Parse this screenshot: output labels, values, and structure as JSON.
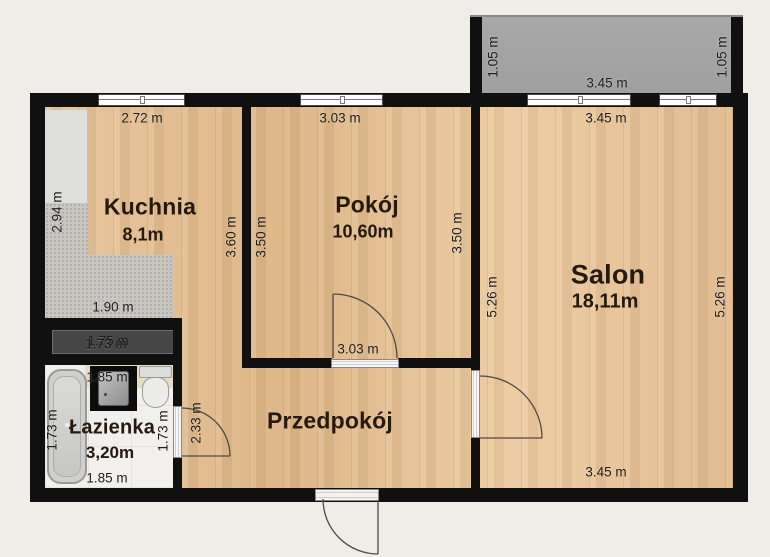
{
  "meta": {
    "type": "apartment-floor-plan",
    "language": "pl"
  },
  "colors": {
    "background": "#f0ede8",
    "wall": "#101010",
    "wood_floor": "#e5bf93",
    "balcony": "#a2a2a2",
    "kitchen_counter": "#cac7c2",
    "closet": "#464646",
    "bathroom_floor": "#f2f0ec",
    "label_text": "#1e1e1e"
  },
  "rooms": [
    {
      "id": "kuchnia",
      "name": "Kuchnia",
      "area": "8,1m",
      "x": 150,
      "y": 207,
      "area_x": 143,
      "area_y": 235,
      "cls": "room-md"
    },
    {
      "id": "pokoj",
      "name": "Pokój",
      "area": "10,60m",
      "x": 367,
      "y": 205,
      "area_x": 363,
      "area_y": 232,
      "cls": "room-md"
    },
    {
      "id": "salon",
      "name": "Salon",
      "area": "18,11m",
      "x": 608,
      "y": 275,
      "area_x": 605,
      "area_y": 302,
      "cls": "room-lg"
    },
    {
      "id": "przedpokoj",
      "name": "Przedpokój",
      "area": "",
      "x": 330,
      "y": 421,
      "cls": "room-md"
    },
    {
      "id": "lazienka",
      "name": "Łazienka",
      "area": "3,20m",
      "x": 112,
      "y": 428,
      "area_x": 110,
      "area_y": 453,
      "cls": "room-sm"
    }
  ],
  "dimension_labels": [
    {
      "text": "2.72 m",
      "x": 142,
      "y": 118,
      "rot": false
    },
    {
      "text": "3.03 m",
      "x": 340,
      "y": 118,
      "rot": false
    },
    {
      "text": "3.45 m",
      "x": 607,
      "y": 83,
      "rot": false
    },
    {
      "text": "3.45 m",
      "x": 606,
      "y": 118,
      "rot": false
    },
    {
      "text": "1.05 m",
      "x": 493,
      "y": 57,
      "rot": true
    },
    {
      "text": "1.05 m",
      "x": 722,
      "y": 57,
      "rot": true
    },
    {
      "text": "2.94 m",
      "x": 57,
      "y": 212,
      "rot": true
    },
    {
      "text": "3.60 m",
      "x": 231,
      "y": 237,
      "rot": true
    },
    {
      "text": "3.50 m",
      "x": 261,
      "y": 237,
      "rot": true
    },
    {
      "text": "3.50 m",
      "x": 457,
      "y": 233,
      "rot": true
    },
    {
      "text": "5.26 m",
      "x": 492,
      "y": 297,
      "rot": true
    },
    {
      "text": "5.26 m",
      "x": 720,
      "y": 297,
      "rot": true
    },
    {
      "text": "1.90 m",
      "x": 113,
      "y": 307,
      "rot": false
    },
    {
      "text": "1.75 m",
      "x": 108,
      "y": 341,
      "rot": false,
      "dark": true
    },
    {
      "text": "1.73 m",
      "x": 106,
      "y": 344,
      "rot": false,
      "dark": true
    },
    {
      "text": "1.85 m",
      "x": 107,
      "y": 377,
      "rot": false
    },
    {
      "text": "1.73 m",
      "x": 52,
      "y": 430,
      "rot": true
    },
    {
      "text": "1.73 m",
      "x": 163,
      "y": 431,
      "rot": true
    },
    {
      "text": "1.85 m",
      "x": 107,
      "y": 478,
      "rot": false
    },
    {
      "text": "2.33 m",
      "x": 196,
      "y": 423,
      "rot": true
    },
    {
      "text": "3.03 m",
      "x": 358,
      "y": 349,
      "rot": false
    },
    {
      "text": "3.45 m",
      "x": 606,
      "y": 472,
      "rot": false
    }
  ]
}
